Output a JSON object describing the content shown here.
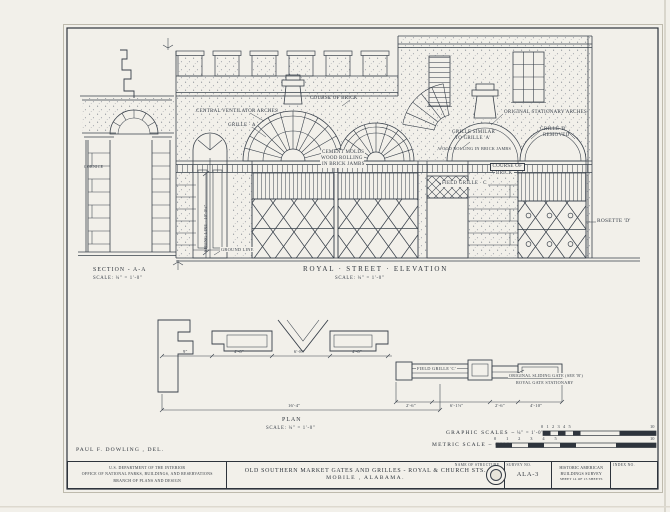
{
  "sheet": {
    "paper": "#f2f0ea",
    "ink": "#2e343c",
    "credit": "PAUL F. DOWLING , DEL."
  },
  "section": {
    "title": "SECTION - A-A",
    "scale": "SCALE: ¼\" = 1'-0\""
  },
  "elevation": {
    "title": "ROYAL · STREET · ELEVATION",
    "scale": "SCALE: ¼\" = 1'-0\"",
    "notes": {
      "central_vent": "CENTRAL VENTILATOR ARCHES",
      "grille_a": "GRILLE · A",
      "course_top": "COURSE OF BRICK",
      "cement1": "CEMENT MOLDS",
      "cement2": "WOOD ROLLING",
      "cement3": "IN BRICK JAMBS",
      "similar1": "GRILLE SIMILAR",
      "similar2": "TO GRILLE 'A'",
      "wood2": "WOOD ROLLING IN BRICK JAMBS",
      "orig_arches": "ORIGINAL STATIONARY ARCHES",
      "grille_b1": "GRILLE 'B'",
      "grille_b2": "REMOVED",
      "field_c": "FIELD GRILLE · C",
      "cob1": "COURSE OF",
      "cob2": "BRICK",
      "rosette": "ROSETTE 'D'",
      "spring": "SPRING LINE · 10'-0½\"",
      "ground": "GROUND LINE",
      "cornice": "CORNICE"
    }
  },
  "plan": {
    "title": "PLAN",
    "scale": "SCALE: ¼\" = 1'-0\"",
    "notes": {
      "field_c": "FIELD GRILLE 'C'",
      "slide1": "ORIGINAL SLIDING GATE (SEE 'B')",
      "slide2": "ROYAL GATE STATIONARY"
    },
    "dims": {
      "overall": "16'-4\"",
      "d1": "2'-6\"",
      "d2": "6'-1½\"",
      "d3": "2'-6\"",
      "d4": "4'-10\"",
      "m1": "9\"",
      "m2": "4'-6\"",
      "m3": "6'-8\"",
      "m4": "4'-6\""
    }
  },
  "scales": {
    "graphic_label": "GRAPHIC SCALES ~",
    "graphic_unit": "¼\" = 1'-0\"",
    "metric_label": "METRIC SCALE ~ CMS.",
    "bar_numbers": "0 1 2 3 4 5",
    "bar_end": "10"
  },
  "titleblock": {
    "dept1": "U.S. DEPARTMENT OF THE INTERIOR",
    "dept2": "OFFICE OF NATIONAL PARKS, BUILDINGS, AND RESERVATIONS",
    "dept3": "BRANCH OF PLANS AND DESIGN",
    "name_hdr": "NAME OF STRUCTURE",
    "name1": "OLD SOUTHERN MARKET GATES AND GRILLES - ROYAL & CHURCH STS.",
    "name2": "MOBILE , ALABAMA.",
    "survey_hdr": "SURVEY NO.",
    "survey_no": "ALA-3",
    "habs1": "HISTORIC AMERICAN",
    "habs2": "BUILDINGS SURVEY",
    "sheet_line": "SHEET 14 OF 15 SHEETS",
    "index_hdr": "INDEX NO."
  }
}
